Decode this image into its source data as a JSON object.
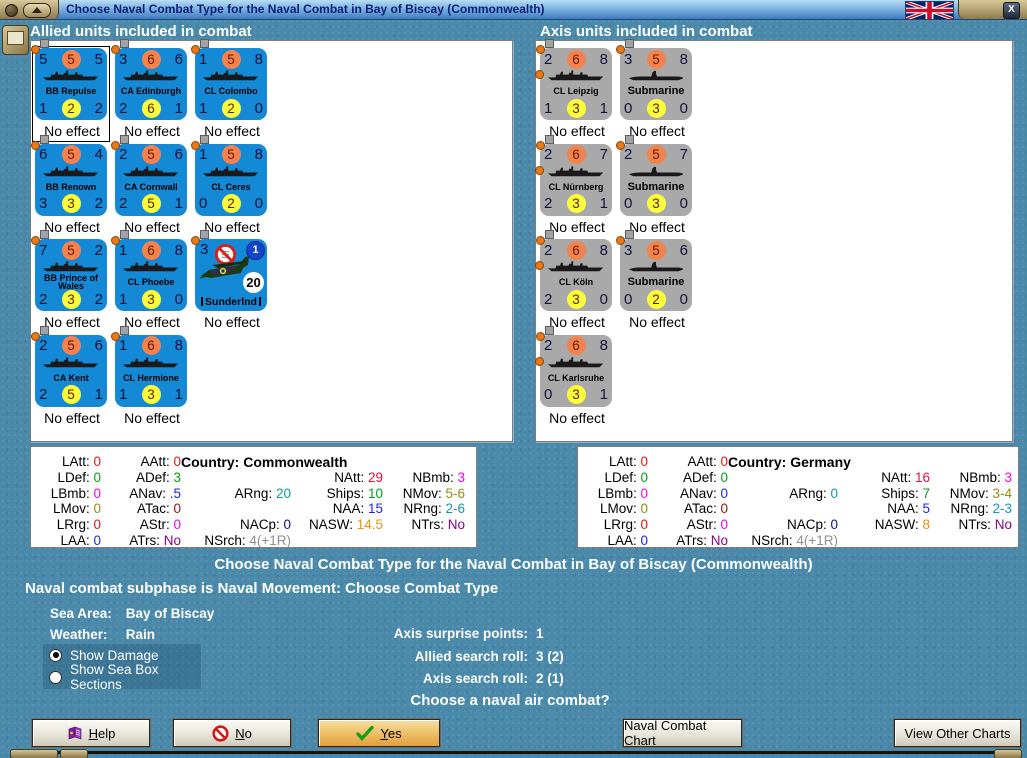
{
  "window": {
    "title": "Choose Naval Combat Type for the Naval Combat in Bay of Biscay (Commonwealth)",
    "close_label": "X"
  },
  "colors": {
    "background": "#4a89a9",
    "allied_counter": "#1489d6",
    "axis_counter": "#a9a9a9",
    "orange_circle": "#f5814d",
    "yellow_circle": "#fdfd3a",
    "yes_button": "#eebc62",
    "title_text": "#0a1e78"
  },
  "stat_colors": {
    "red": "#e11414",
    "green": "#00a018",
    "magenta": "#ee00ee",
    "olive": "#8f8f10",
    "blue": "#2222ee",
    "darkred": "#971010",
    "purple": "#8b008b",
    "teal": "#0f9aa8",
    "navy": "#101090",
    "gray": "#8f8f8f",
    "crimson": "#e0143c",
    "orange": "#ef9010",
    "black": "#000000"
  },
  "allied_panel": {
    "heading": "Allied units included in combat",
    "units": [
      {
        "name": "BB Repulse",
        "kind": "ship",
        "top": [
          "5",
          "5",
          "5"
        ],
        "bottom": [
          "1",
          "2",
          "2"
        ],
        "status": "No effect",
        "selected": true
      },
      {
        "name": "CA Edinburgh",
        "kind": "ship",
        "top": [
          "3",
          "6",
          "6"
        ],
        "bottom": [
          "2",
          "6",
          "1"
        ],
        "status": "No effect"
      },
      {
        "name": "CL Colombo",
        "kind": "ship",
        "top": [
          "1",
          "5",
          "8"
        ],
        "bottom": [
          "1",
          "2",
          "0"
        ],
        "status": "No effect"
      },
      {
        "name": "BB Renown",
        "kind": "ship",
        "top": [
          "6",
          "5",
          "4"
        ],
        "bottom": [
          "3",
          "3",
          "2"
        ],
        "status": "No effect"
      },
      {
        "name": "CA Cornwall",
        "kind": "ship",
        "top": [
          "2",
          "5",
          "6"
        ],
        "bottom": [
          "2",
          "5",
          "1"
        ],
        "status": "No effect"
      },
      {
        "name": "CL Ceres",
        "kind": "ship",
        "top": [
          "1",
          "5",
          "8"
        ],
        "bottom": [
          "0",
          "2",
          "0"
        ],
        "status": "No effect"
      },
      {
        "name": "BB Prince of Wales",
        "kind": "ship",
        "top": [
          "7",
          "5",
          "2"
        ],
        "bottom": [
          "2",
          "3",
          "2"
        ],
        "status": "No effect"
      },
      {
        "name": "CL Phoebe",
        "kind": "ship",
        "top": [
          "1",
          "6",
          "8"
        ],
        "bottom": [
          "1",
          "3",
          "0"
        ],
        "status": "No effect"
      },
      {
        "name": "Sunderlnd",
        "kind": "aircraft",
        "corner": "3",
        "badge": "1",
        "value": "20",
        "status": "No effect"
      },
      {
        "name": "CA Kent",
        "kind": "ship",
        "top": [
          "2",
          "5",
          "6"
        ],
        "bottom": [
          "2",
          "5",
          "1"
        ],
        "status": "No effect"
      },
      {
        "name": "CL Hermione",
        "kind": "ship",
        "top": [
          "1",
          "6",
          "8"
        ],
        "bottom": [
          "1",
          "3",
          "1"
        ],
        "status": "No effect"
      }
    ],
    "stats": {
      "cells": [
        {
          "r": 1,
          "c": 1,
          "l": "LAtt:",
          "v": "0",
          "col": "red"
        },
        {
          "r": 1,
          "c": 2,
          "l": "AAtt:",
          "v": "0",
          "col": "red"
        },
        {
          "r": 1,
          "c": 3,
          "span": 3,
          "l": "Country:",
          "v": "Commonwealth",
          "col": "black",
          "bold": true
        },
        {
          "r": 2,
          "c": 1,
          "l": "LDef:",
          "v": "0",
          "col": "green"
        },
        {
          "r": 2,
          "c": 2,
          "l": "ADef:",
          "v": "3",
          "col": "green"
        },
        {
          "r": 2,
          "c": 4,
          "l": "NAtt:",
          "v": "29",
          "col": "crimson"
        },
        {
          "r": 2,
          "c": 5,
          "l": "NBmb:",
          "v": "3",
          "col": "magenta"
        },
        {
          "r": 3,
          "c": 1,
          "l": "LBmb:",
          "v": "0",
          "col": "magenta"
        },
        {
          "r": 3,
          "c": 2,
          "l": "ANav:",
          "v": ".5",
          "col": "blue"
        },
        {
          "r": 3,
          "c": 3,
          "l": "ARng:",
          "v": "20",
          "col": "teal"
        },
        {
          "r": 3,
          "c": 4,
          "l": "Ships:",
          "v": "10",
          "col": "green"
        },
        {
          "r": 3,
          "c": 5,
          "l": "NMov:",
          "v": "5-6",
          "col": "olive"
        },
        {
          "r": 4,
          "c": 1,
          "l": "LMov:",
          "v": "0",
          "col": "olive"
        },
        {
          "r": 4,
          "c": 2,
          "l": "ATac:",
          "v": "0",
          "col": "darkred"
        },
        {
          "r": 4,
          "c": 4,
          "l": "NAA:",
          "v": "15",
          "col": "blue"
        },
        {
          "r": 4,
          "c": 5,
          "l": "NRng:",
          "v": "2-6",
          "col": "teal"
        },
        {
          "r": 5,
          "c": 1,
          "l": "LRrg:",
          "v": "0",
          "col": "red"
        },
        {
          "r": 5,
          "c": 2,
          "l": "AStr:",
          "v": "0",
          "col": "magenta"
        },
        {
          "r": 5,
          "c": 3,
          "l": "NACp:",
          "v": "0",
          "col": "navy"
        },
        {
          "r": 5,
          "c": 4,
          "l": "NASW:",
          "v": "14.5",
          "col": "orange"
        },
        {
          "r": 5,
          "c": 5,
          "l": "NTrs:",
          "v": "No",
          "col": "purple"
        },
        {
          "r": 6,
          "c": 1,
          "l": "LAA:",
          "v": "0",
          "col": "blue"
        },
        {
          "r": 6,
          "c": 2,
          "l": "ATrs:",
          "v": "No",
          "col": "purple"
        },
        {
          "r": 6,
          "c": 3,
          "l": "NSrch:",
          "v": "4(+1R)",
          "col": "gray"
        }
      ]
    }
  },
  "axis_panel": {
    "heading": "Axis units included in combat",
    "units": [
      {
        "name": "CL Leipzig",
        "kind": "ship",
        "top": [
          "2",
          "6",
          "8"
        ],
        "bottom": [
          "1",
          "3",
          "1"
        ],
        "status": "No effect",
        "extra_pip": true
      },
      {
        "name": "Submarine",
        "kind": "submarine",
        "top": [
          "3",
          "5",
          "8"
        ],
        "bottom": [
          "0",
          "3",
          "0"
        ],
        "status": "No effect"
      },
      {
        "name": "CL Nürnberg",
        "kind": "ship",
        "top": [
          "2",
          "6",
          "7"
        ],
        "bottom": [
          "2",
          "3",
          "1"
        ],
        "status": "No effect",
        "extra_pip": true
      },
      {
        "name": "Submarine",
        "kind": "submarine",
        "top": [
          "2",
          "5",
          "7"
        ],
        "bottom": [
          "0",
          "3",
          "0"
        ],
        "status": "No effect"
      },
      {
        "name": "CL Köln",
        "kind": "ship",
        "top": [
          "2",
          "6",
          "8"
        ],
        "bottom": [
          "2",
          "3",
          "0"
        ],
        "status": "No effect",
        "extra_pip": true
      },
      {
        "name": "Submarine",
        "kind": "submarine",
        "top": [
          "3",
          "5",
          "6"
        ],
        "bottom": [
          "0",
          "2",
          "0"
        ],
        "status": "No effect"
      },
      {
        "name": "CL Karlsruhe",
        "kind": "ship",
        "top": [
          "2",
          "6",
          "8"
        ],
        "bottom": [
          "0",
          "3",
          "1"
        ],
        "status": "No effect",
        "extra_pip": true
      }
    ],
    "stats": {
      "cells": [
        {
          "r": 1,
          "c": 1,
          "l": "LAtt:",
          "v": "0",
          "col": "red"
        },
        {
          "r": 1,
          "c": 2,
          "l": "AAtt:",
          "v": "0",
          "col": "red"
        },
        {
          "r": 1,
          "c": 3,
          "span": 3,
          "l": "Country:",
          "v": "Germany",
          "col": "black",
          "bold": true
        },
        {
          "r": 2,
          "c": 1,
          "l": "LDef:",
          "v": "0",
          "col": "green"
        },
        {
          "r": 2,
          "c": 2,
          "l": "ADef:",
          "v": "0",
          "col": "green"
        },
        {
          "r": 2,
          "c": 4,
          "l": "NAtt:",
          "v": "16",
          "col": "crimson"
        },
        {
          "r": 2,
          "c": 5,
          "l": "NBmb:",
          "v": "3",
          "col": "magenta"
        },
        {
          "r": 3,
          "c": 1,
          "l": "LBmb:",
          "v": "0",
          "col": "magenta"
        },
        {
          "r": 3,
          "c": 2,
          "l": "ANav:",
          "v": "0",
          "col": "blue"
        },
        {
          "r": 3,
          "c": 3,
          "l": "ARng:",
          "v": "0",
          "col": "teal"
        },
        {
          "r": 3,
          "c": 4,
          "l": "Ships:",
          "v": "7",
          "col": "green"
        },
        {
          "r": 3,
          "c": 5,
          "l": "NMov:",
          "v": "3-4",
          "col": "olive"
        },
        {
          "r": 4,
          "c": 1,
          "l": "LMov:",
          "v": "0",
          "col": "olive"
        },
        {
          "r": 4,
          "c": 2,
          "l": "ATac:",
          "v": "0",
          "col": "darkred"
        },
        {
          "r": 4,
          "c": 4,
          "l": "NAA:",
          "v": "5",
          "col": "blue"
        },
        {
          "r": 4,
          "c": 5,
          "l": "NRng:",
          "v": "2-3",
          "col": "teal"
        },
        {
          "r": 5,
          "c": 1,
          "l": "LRrg:",
          "v": "0",
          "col": "red"
        },
        {
          "r": 5,
          "c": 2,
          "l": "AStr:",
          "v": "0",
          "col": "magenta"
        },
        {
          "r": 5,
          "c": 3,
          "l": "NACp:",
          "v": "0",
          "col": "navy"
        },
        {
          "r": 5,
          "c": 4,
          "l": "NASW:",
          "v": "8",
          "col": "orange"
        },
        {
          "r": 5,
          "c": 5,
          "l": "NTrs:",
          "v": "No",
          "col": "purple"
        },
        {
          "r": 6,
          "c": 1,
          "l": "LAA:",
          "v": "0",
          "col": "blue"
        },
        {
          "r": 6,
          "c": 2,
          "l": "ATrs:",
          "v": "No",
          "col": "purple"
        },
        {
          "r": 6,
          "c": 3,
          "l": "NSrch:",
          "v": "4(+1R)",
          "col": "gray"
        }
      ]
    }
  },
  "info": {
    "main_heading": "Choose Naval Combat Type for the Naval Combat in Bay of Biscay (Commonwealth)",
    "subphase": "Naval combat subphase is Naval Movement: Choose Combat Type",
    "sea_area_label": "Sea Area:",
    "sea_area_value": "Bay of Biscay",
    "weather_label": "Weather:",
    "weather_value": "Rain",
    "question": "Choose a naval air combat?"
  },
  "options": [
    {
      "label": "Show Damage",
      "selected": true
    },
    {
      "label": "Show Sea Box Sections",
      "selected": false
    }
  ],
  "rolls": [
    {
      "id": "axis-surprise-points",
      "label": "Axis surprise points:",
      "value": "1"
    },
    {
      "id": "allied-search-roll",
      "label": "Allied search roll:",
      "value": "3 (2)"
    },
    {
      "id": "axis-search-roll",
      "label": "Axis search roll:",
      "value": "2 (1)"
    }
  ],
  "buttons": {
    "help": {
      "label": "Help"
    },
    "no": {
      "label": "No"
    },
    "yes": {
      "label": "Yes"
    },
    "naval_combat_chart": {
      "label": "Naval Combat Chart"
    },
    "view_other_charts": {
      "label": "View Other Charts"
    }
  }
}
